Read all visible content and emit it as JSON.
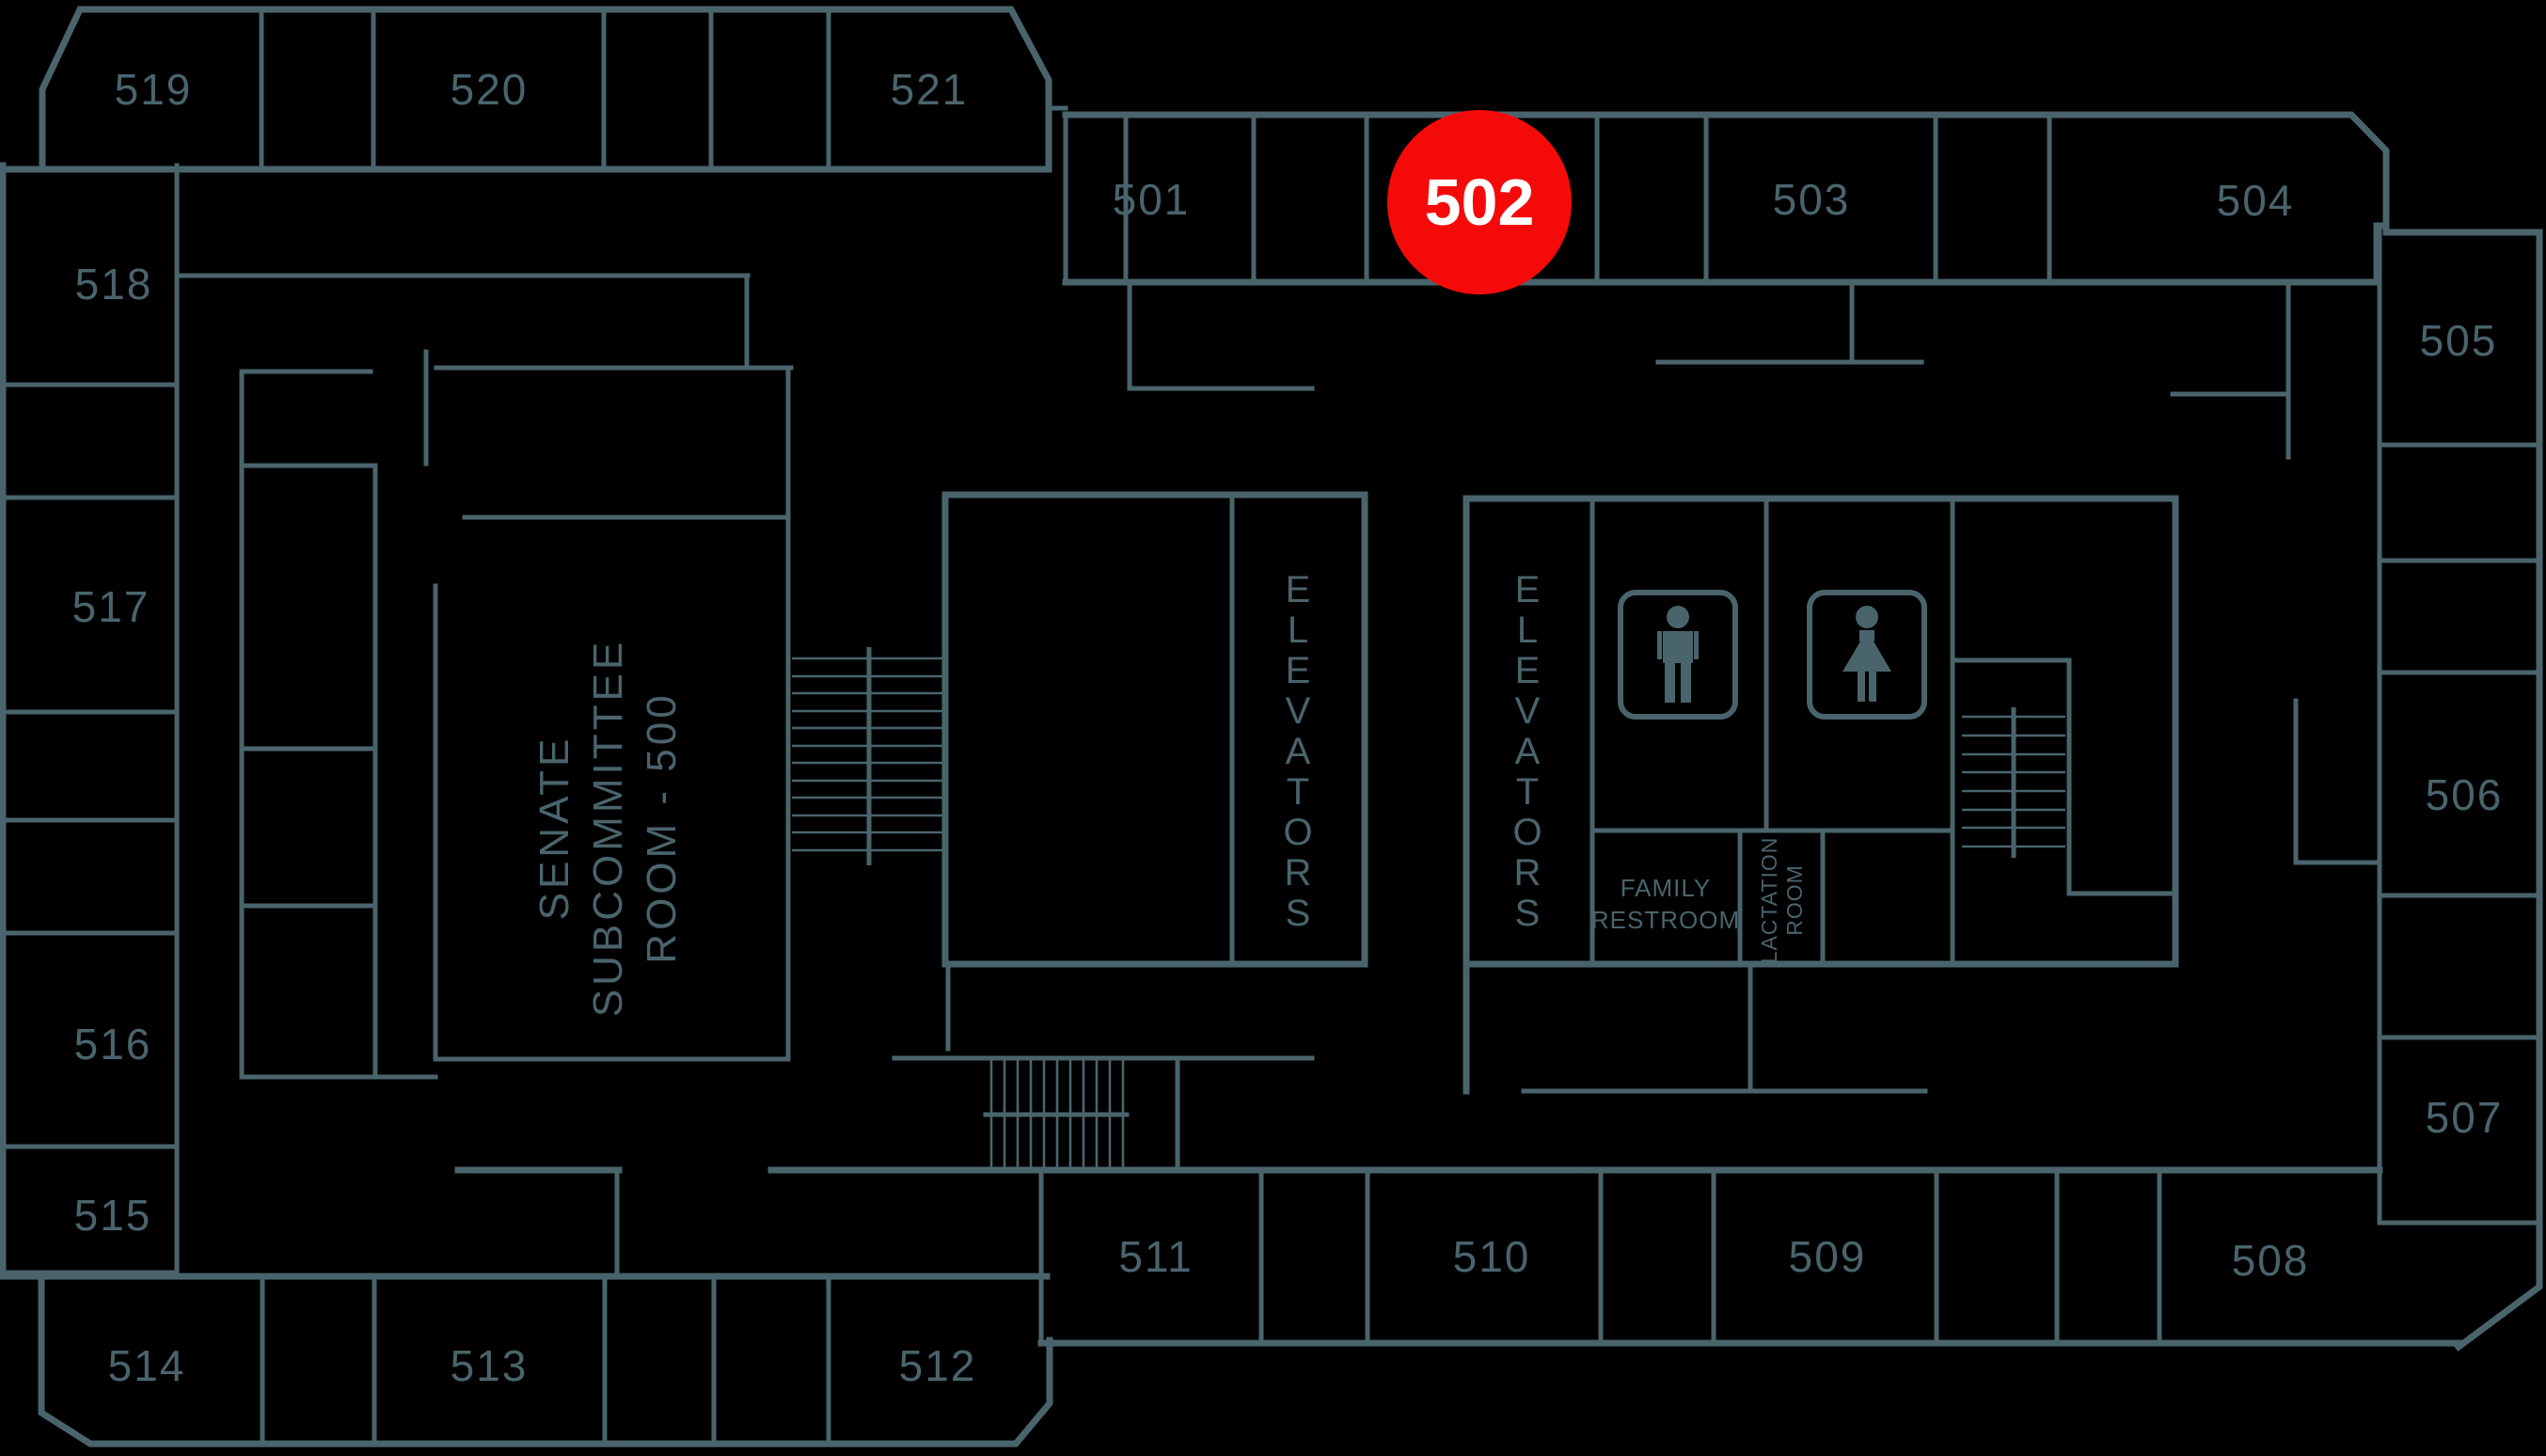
{
  "colors": {
    "background": "#000000",
    "wall": "#4a646c",
    "marker": "#f50a0a",
    "marker_text": "#ffffff"
  },
  "marker": {
    "label": "502",
    "room": "502"
  },
  "rooms": {
    "r501": "501",
    "r503": "503",
    "r504": "504",
    "r505": "505",
    "r506": "506",
    "r507": "507",
    "r508": "508",
    "r509": "509",
    "r510": "510",
    "r511": "511",
    "r512": "512",
    "r513": "513",
    "r514": "514",
    "r515": "515",
    "r516": "516",
    "r517": "517",
    "r518": "518",
    "r519": "519",
    "r520": "520",
    "r521": "521"
  },
  "labels": {
    "senate_room": [
      "SENATE",
      "SUBCOMMITTEE",
      "ROOM - 500"
    ],
    "elevators_left": "ELEVATORS",
    "elevators_right": "ELEVATORS",
    "family_restroom": [
      "FAMILY",
      "RESTROOM"
    ],
    "lactation_room": [
      "LACTATION",
      "ROOM"
    ]
  },
  "icons": {
    "mens_restroom": "mens-restroom-icon",
    "womens_restroom": "womens-restroom-icon"
  }
}
